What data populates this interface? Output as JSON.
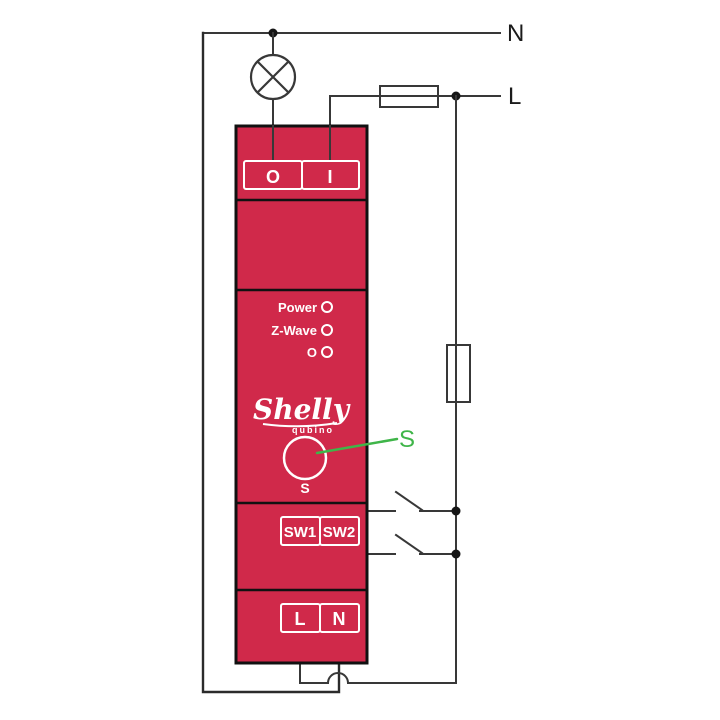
{
  "diagram": {
    "title": "shelly-qubino-wave-wiring-diagram",
    "mains": {
      "neutral_label": "N",
      "live_label": "L"
    },
    "annotation": {
      "s_label": "S"
    },
    "device": {
      "brand": "Shelly",
      "sub_brand": "qubino",
      "terminals_top": [
        "O",
        "I"
      ],
      "leds": [
        "Power",
        "Z-Wave",
        "O"
      ],
      "button_label": "S",
      "terminals_sw": [
        "SW1",
        "SW2"
      ],
      "terminals_bottom": [
        "L",
        "N"
      ]
    },
    "colors": {
      "device_red": "#D0294A",
      "wire_dark": "#383838",
      "annotation_green": "#3FB549",
      "terminal_outline": "#FFFFFF",
      "junction_black": "#161616"
    }
  }
}
